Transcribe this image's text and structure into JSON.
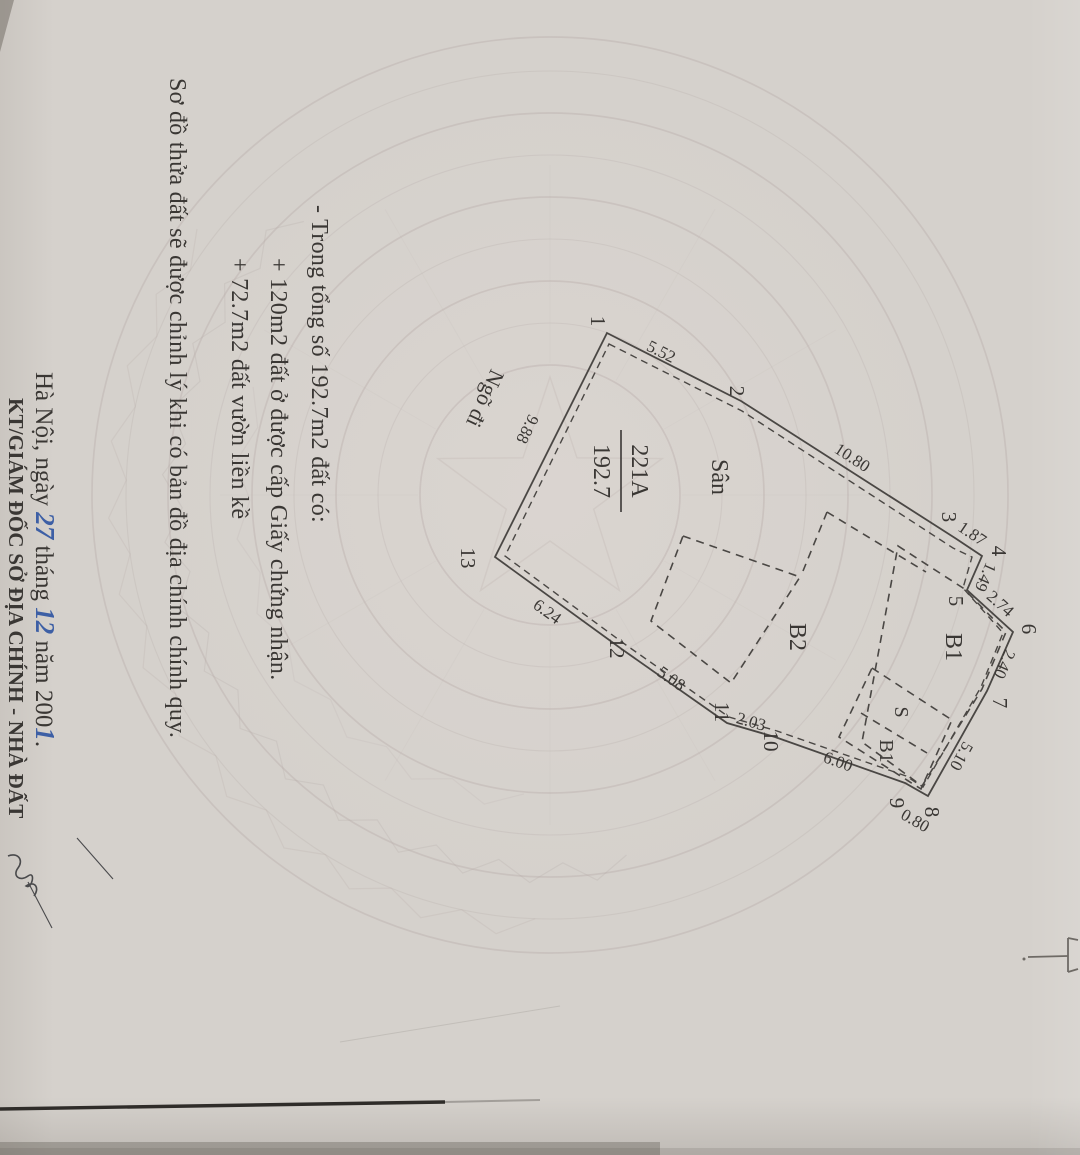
{
  "notes": {
    "line1": "- Trong tổng số 192.7m2 đất có:",
    "line2": "+ 120m2 đất ở được cấp Giấy chứng nhận.",
    "line3": "+ 72.7m2 đất vườn liền kề",
    "line4": "Sơ đồ thửa đất sẽ được chỉnh lý khi có bản đồ địa chính chính quy."
  },
  "diagram": {
    "parcel_number": "221A",
    "parcel_area": "192.7",
    "yard_label": "Sân",
    "building_b2": "B2",
    "building_b1": "B1",
    "annex_s": "S",
    "annex_b1": "B1",
    "alley_label": "Ngõ đi",
    "vertices": [
      "1",
      "2",
      "3",
      "4",
      "5",
      "6",
      "7",
      "8",
      "9",
      "10",
      "11",
      "12",
      "13"
    ],
    "edge_lengths": {
      "e1_2": "5.52",
      "e2_3": "10.80",
      "e3_4": "1.87",
      "e4_5": "1.49",
      "e5_6": "2.74",
      "e6_7": "2.40",
      "e7_8": "5.10",
      "e8_9": "0.80",
      "e9_10": "6.00",
      "e10_11": "2.03",
      "e11_12": "5.08",
      "e12_13": "6.24",
      "e13_1": "9.88"
    }
  },
  "signature_block": {
    "place_and_day_prefix": "Hà Nội, ngày ",
    "day_handwritten": "27",
    "month_label": " tháng ",
    "month_handwritten": "12",
    "year_label": " năm ",
    "year_printed": "200",
    "year_handwritten": "1",
    "period": ".",
    "signer_title": "KT/GIÁM ĐỐC SỞ ĐỊA CHÍNH - NHÀ ĐẤT"
  },
  "colors": {
    "paper": "#d5d1cc",
    "ink": "#3a3734",
    "boundary": "#4a4744",
    "handwriting_blue": "#3d5fa5",
    "watermark": "#b9aeab"
  }
}
